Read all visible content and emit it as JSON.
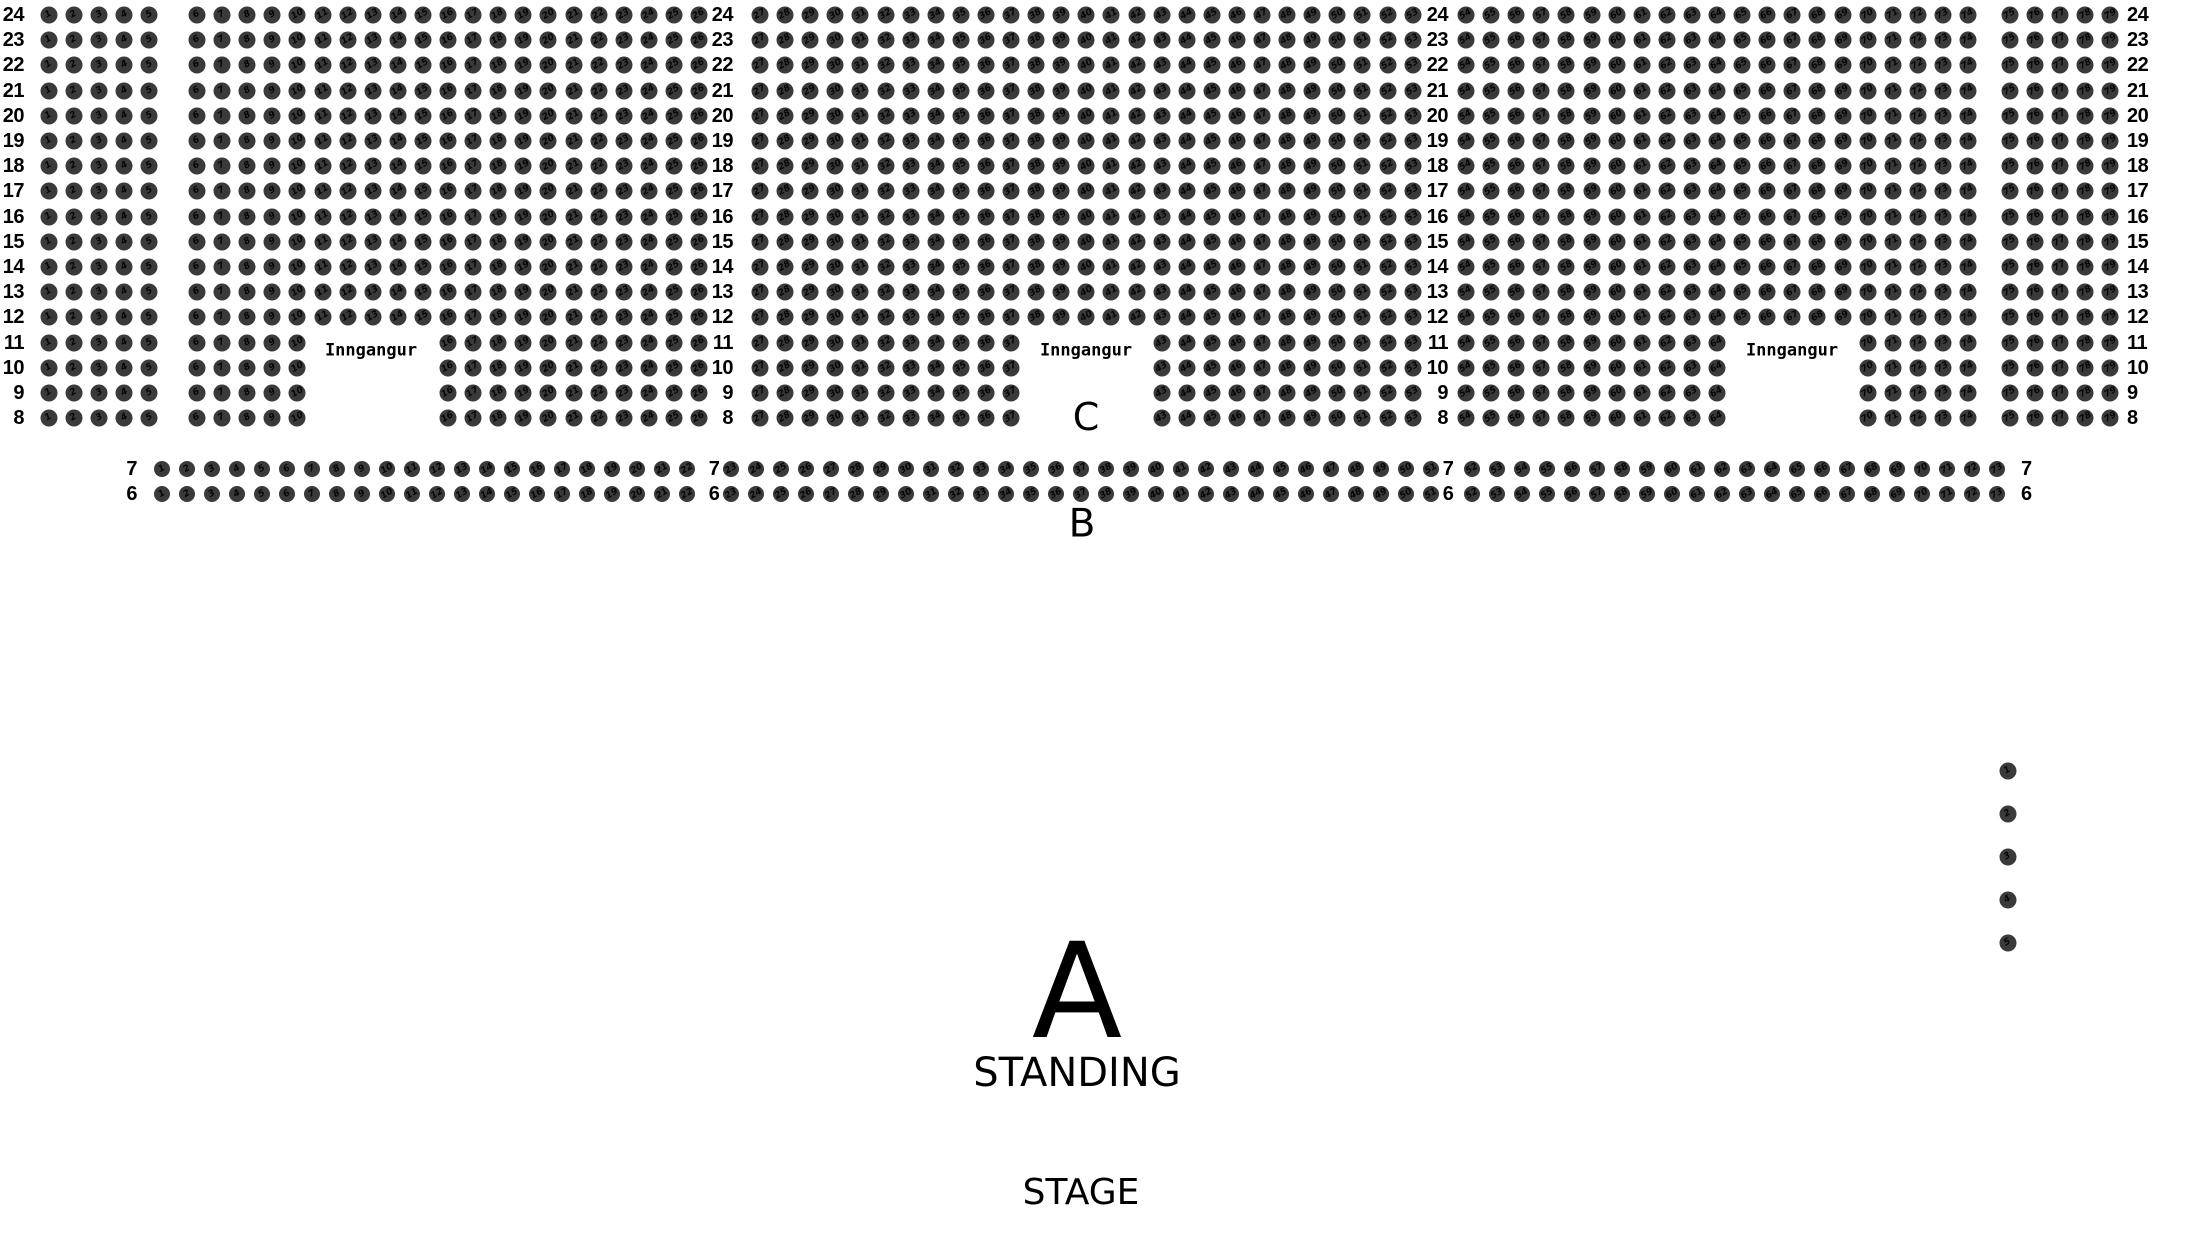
{
  "colors": {
    "background": "#ffffff",
    "seat_fill": "#3a3a3a",
    "text": "#000000"
  },
  "upper_section": {
    "row_numbers": [
      24,
      23,
      22,
      21,
      20,
      19,
      18,
      17,
      16,
      15,
      14,
      13,
      12,
      11,
      10,
      9,
      8
    ],
    "seat_blocks": [
      {
        "seat_from": 1,
        "seat_to": 5
      },
      {
        "seat_from": 6,
        "seat_to": 26
      },
      {
        "seat_from": 27,
        "seat_to": 53
      },
      {
        "seat_from": 54,
        "seat_to": 74
      },
      {
        "seat_from": 75,
        "seat_to": 79
      }
    ],
    "entrance_row_numbers": [
      11,
      10,
      9,
      8
    ],
    "entrances": [
      {
        "label": "Inngangur",
        "replaces_seat_from": 11,
        "replaces_seat_to": 15
      },
      {
        "label": "Inngangur",
        "replaces_seat_from": 38,
        "replaces_seat_to": 42
      },
      {
        "label": "Inngangur",
        "replaces_seat_from": 65,
        "replaces_seat_to": 69
      }
    ],
    "section_c_label": "C"
  },
  "row_b_section": {
    "section_label": "B",
    "row_numbers": [
      7,
      6
    ],
    "seat_blocks": [
      {
        "seat_from": 1,
        "seat_to": 22
      },
      {
        "seat_from": 23,
        "seat_to": 51
      },
      {
        "seat_from": 52,
        "seat_to": 73
      }
    ]
  },
  "side_seat_column": {
    "seat_numbers": [
      1,
      2,
      3,
      4,
      5
    ]
  },
  "standing_section": {
    "section_label": "A",
    "label": "STANDING"
  },
  "stage": {
    "label": "STAGE"
  }
}
